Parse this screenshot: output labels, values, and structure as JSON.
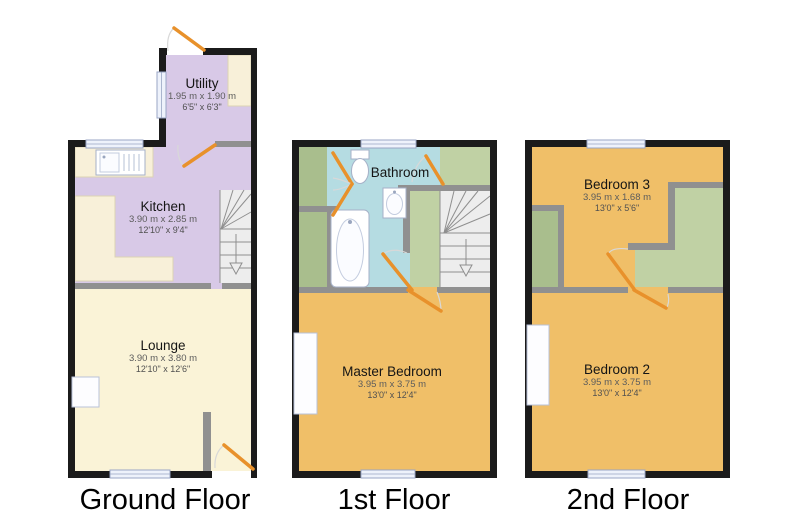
{
  "floors": [
    {
      "title": "Ground Floor",
      "rooms": [
        {
          "name": "Utility",
          "metric": "1.95 m x 1.90 m",
          "imperial": "6'5\" x 6'3\""
        },
        {
          "name": "Kitchen",
          "metric": "3.90 m x 2.85 m",
          "imperial": "12'10\" x 9'4\""
        },
        {
          "name": "Lounge",
          "metric": "3.90 m x 3.80 m",
          "imperial": "12'10\" x 12'6\""
        }
      ]
    },
    {
      "title": "1st Floor",
      "rooms": [
        {
          "name": "Bathroom",
          "metric": "",
          "imperial": ""
        },
        {
          "name": "Master Bedroom",
          "metric": "3.95 m x 3.75 m",
          "imperial": "13'0\" x 12'4\""
        }
      ]
    },
    {
      "title": "2nd Floor",
      "rooms": [
        {
          "name": "Bedroom 3",
          "metric": "3.95 m x 1.68 m",
          "imperial": "13'0\" x 5'6\""
        },
        {
          "name": "Bedroom 2",
          "metric": "3.95 m x 3.75 m",
          "imperial": "13'0\" x 12'4\""
        }
      ]
    }
  ],
  "colors": {
    "wall": "#1b1b1b",
    "interior-wall": "#909090",
    "lavender": "#d8c9e7",
    "cream": "#faf3d7",
    "counter": "#f8f0d9",
    "cyan": "#b5dce2",
    "orange": "#f0bf68",
    "green-closet": "#a9be8d",
    "green-landing": "#c0d1a4",
    "stairs": "#ededed",
    "door": "#e8912b",
    "window-fill": "#eef2fb",
    "window-border": "#99a5c4",
    "arc": "#d8d8d8"
  }
}
